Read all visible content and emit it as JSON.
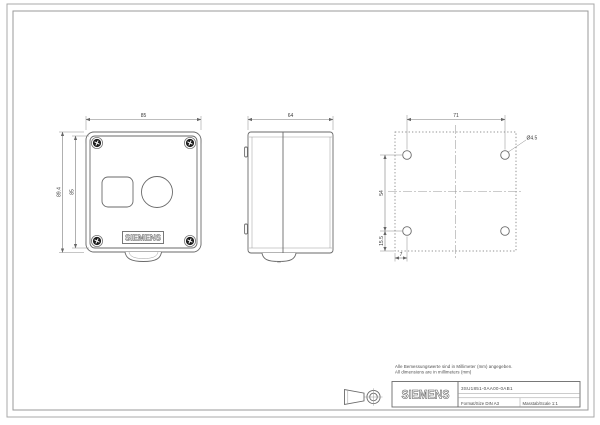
{
  "sheet": {
    "note_line1": "Alle Bemessungswerte sind in Millimeter (mm) angegeben.",
    "note_line2": "All dimensions are in millimeters (mm)"
  },
  "title_block": {
    "brand": "SIEMENS",
    "part_number": "3SU1851-0AA00-0AB1",
    "format_label": "Format/Size DIN A3",
    "scale_label": "Masstab/Scale 1:1"
  },
  "front_view": {
    "nameplate": "SIEMENS",
    "dim_width": "85",
    "dim_height_outer": "89.4",
    "dim_height_face": "85"
  },
  "side_view": {
    "dim_depth": "64"
  },
  "drill_view": {
    "dim_hole_pitch_x": "71",
    "dim_hole_pitch_y": "54",
    "dim_offset_bottom": "15.5",
    "dim_offset_left": "7",
    "hole_diameter": "Ø4.5"
  }
}
